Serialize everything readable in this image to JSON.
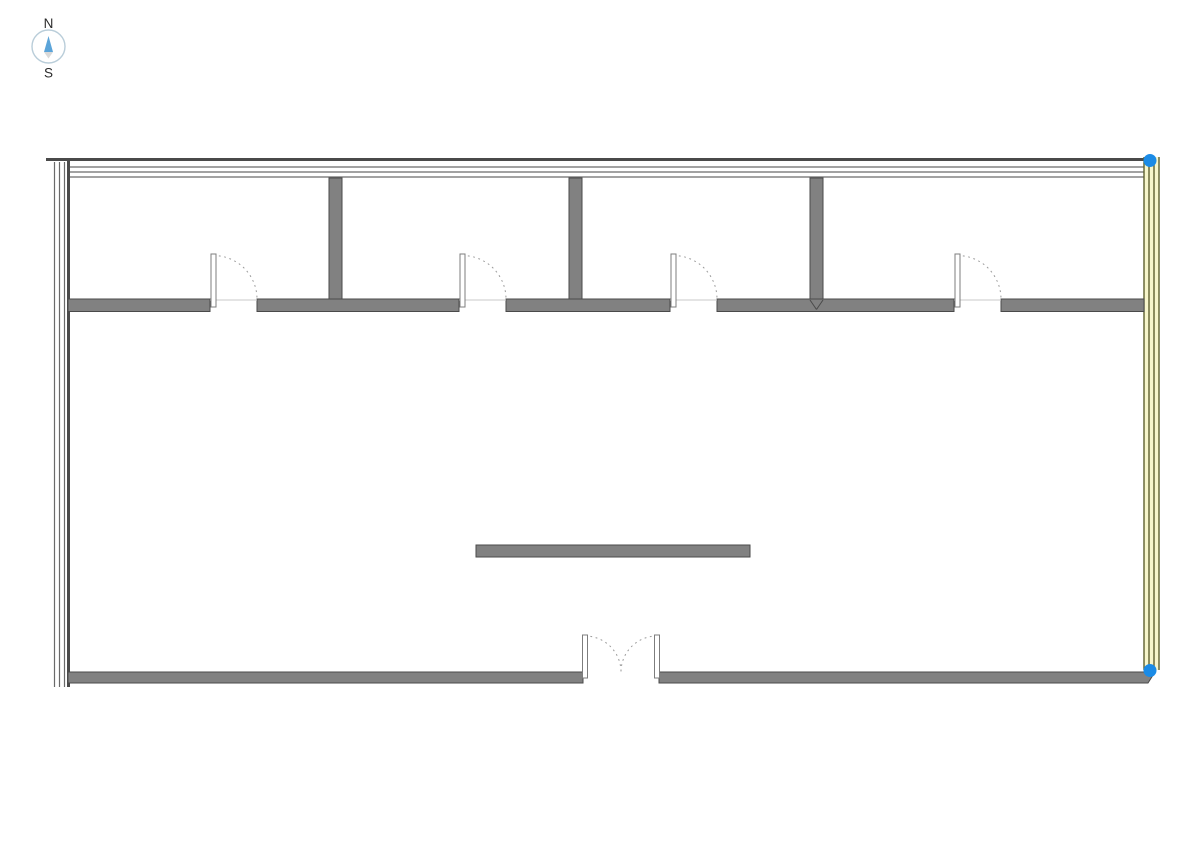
{
  "compass": {
    "north_label": "N",
    "south_label": "S",
    "cx": 48.5,
    "cy": 46.5,
    "r": 16.5
  },
  "colors": {
    "background": "#ffffff",
    "wall_fill": "#818181",
    "wall_edge": "#4a4a4a",
    "wall_line": "#6a6a6a",
    "highlight_line": "#5e602f",
    "highlight_fill": "#f7f6cb",
    "grip": "#1b8be6",
    "leaf_fill": "#ffffff",
    "leaf_edge": "#7d7d7d",
    "arc": "#9a9a9a",
    "threshold": "#c8c8c8",
    "compass_ring": "#b9cdd9",
    "compass_north": "#5ba4d9",
    "compass_tail": "#d9d9d9",
    "text": "#2b2b2b"
  },
  "plan": {
    "canvas": {
      "w": 1191,
      "h": 842
    },
    "walls": {
      "north": {
        "thick": {
          "x1": 46,
          "x2": 1144,
          "y": 159.5
        },
        "thin_ys": [
          167,
          172,
          177
        ],
        "thin_x1": 69,
        "thin_x2": 1144
      },
      "west": {
        "thin_xs": [
          54.5,
          59.5,
          64.5
        ],
        "thick_x": 68.5,
        "y1": 162,
        "y2": 687,
        "thick_y1": 159,
        "thick_y2": 687
      },
      "east": {
        "xs": [
          1144,
          1149,
          1154,
          1159
        ],
        "y1": 157,
        "y2": 670
      },
      "south": {
        "y1": 672,
        "y2": 683,
        "left_segment": [
          68,
          583
        ],
        "right_segment": [
          659,
          1155,
          1148
        ]
      },
      "corridor": {
        "y1": 299,
        "h": 12.5,
        "segments": [
          [
            68,
            210
          ],
          [
            257,
            459
          ],
          [
            506,
            670
          ],
          [
            717,
            954
          ],
          [
            1001,
            1144
          ]
        ]
      },
      "partitions": [
        {
          "x": 329,
          "y": 178,
          "w": 13,
          "h": 121
        },
        {
          "x": 569,
          "y": 178,
          "w": 13,
          "h": 121
        },
        {
          "x": 810,
          "y": 178,
          "w": 13,
          "h": 121,
          "notch": true
        }
      ],
      "island": {
        "x": 476,
        "y": 545,
        "w": 274,
        "h": 12
      }
    },
    "doors": {
      "single": [
        {
          "jamb_l": 210,
          "jamb_r": 257
        },
        {
          "jamb_l": 459,
          "jamb_r": 506
        },
        {
          "jamb_l": 670,
          "jamb_r": 717
        },
        {
          "jamb_l": 954,
          "jamb_r": 1001
        }
      ],
      "leaf": {
        "w": 5,
        "top": 254,
        "h": 53
      },
      "double": {
        "jamb_l": 582,
        "jamb_r": 660,
        "leaf_top": 635,
        "leaf_h": 43,
        "meet_x": 621,
        "sill_y": 672
      }
    },
    "grips": [
      {
        "cx": 1150,
        "cy": 160.5
      },
      {
        "cx": 1150,
        "cy": 670.5
      }
    ],
    "grip_r": 6.5
  }
}
